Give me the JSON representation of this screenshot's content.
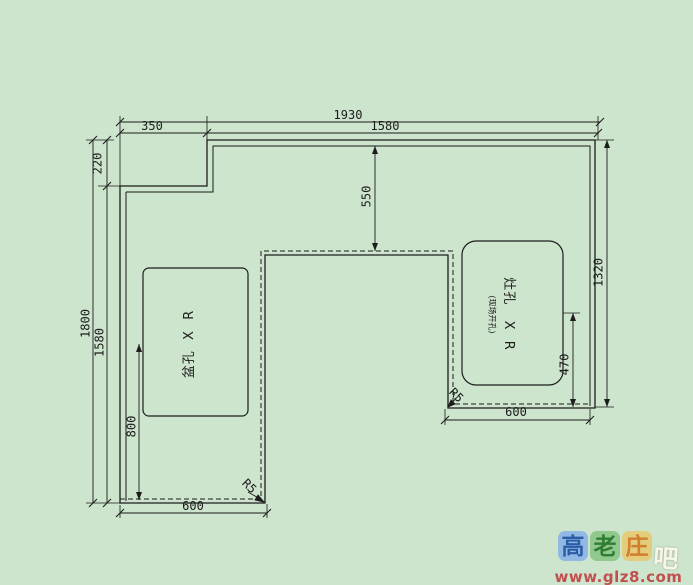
{
  "drawing": {
    "background_color": "#cde4cd",
    "line_color": "#1c1c1c",
    "dimensions": {
      "top_total": "1930",
      "top_left_segment": "350",
      "top_right_segment": "1580",
      "left_notch_height": "220",
      "left_outer_height": "1800",
      "left_inner_height": "1580",
      "sink_center_to_front": "800",
      "top_band_depth": "550",
      "right_outer_height": "1320",
      "stove_center_to_front": "470",
      "right_leg_width": "600",
      "left_leg_width": "600"
    },
    "callouts": {
      "corner_radius_left": "R5",
      "corner_radius_right": "R5"
    },
    "cutouts": {
      "sink_label": "盆孔  X  R",
      "stove_label": "灶孔   X  R",
      "stove_note": "(现场开孔)"
    }
  },
  "watermark": {
    "badges": [
      {
        "char": "高",
        "bg": "#92b9e3",
        "fg": "#2b5ca8"
      },
      {
        "char": "老",
        "bg": "#90c88e",
        "fg": "#2e7d32"
      },
      {
        "char": "庄",
        "bg": "#e4cc7d",
        "fg": "#cf7f2e"
      }
    ],
    "suffix": "吧",
    "url": "www.glz8.com",
    "url_color": "#c0504d"
  }
}
